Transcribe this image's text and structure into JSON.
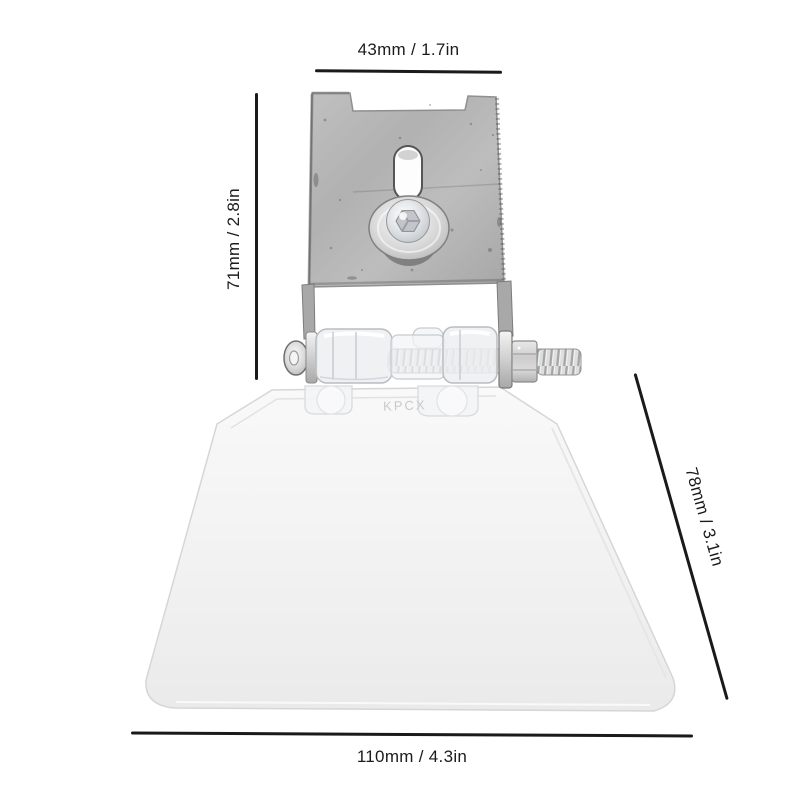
{
  "page": {
    "background": "#ffffff",
    "kind": "product photo with dimension annotations"
  },
  "dimension_labels": {
    "top": "43mm / 1.7in",
    "left": "71mm / 2.8in",
    "right_diagonal": "78mm / 3.1in",
    "bottom": "110mm / 4.3in"
  },
  "product": {
    "embossed_text": "KPCX",
    "parts": [
      "metal-mounting-bracket-plate",
      "vertical-adjustment-slot",
      "washer",
      "screw-head",
      "hinge-pin-threaded-rod",
      "clear-hinge-knuckles",
      "hex-nut",
      "threaded-bolt-end",
      "clear-plastic-flap"
    ]
  },
  "colors": {
    "dimension_line": "#1a1a1a",
    "dimension_text": "#1b1b1b",
    "bracket_metal": "#b3b3b3",
    "silver_hardware": "#d8d8d8",
    "clear_plastic": "#edeff1",
    "flap_white": "#f1f1f1"
  }
}
